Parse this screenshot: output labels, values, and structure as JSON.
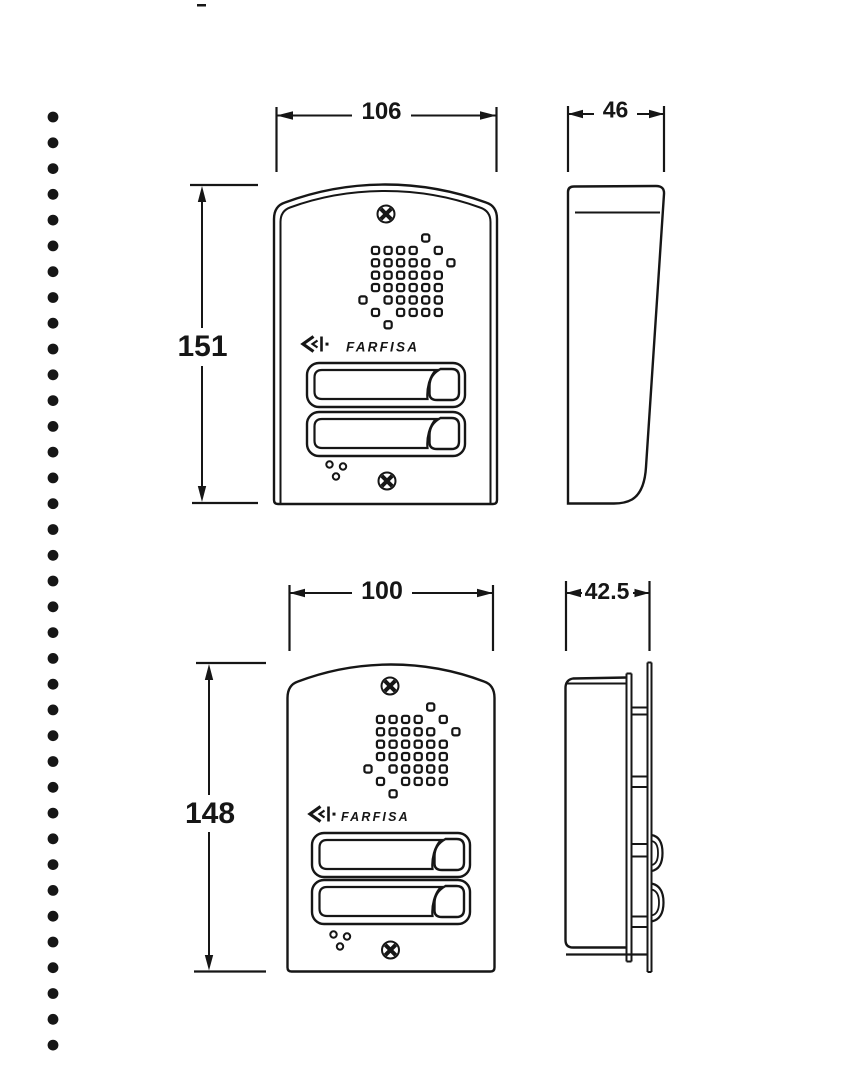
{
  "drawing": {
    "ink_color": "#161616",
    "paper_color": "#ffffff",
    "binding_dots_count": 37,
    "brand_logo_text": "FARFISA",
    "views": {
      "surface_front": {
        "width_mm": "106",
        "height_mm": "151"
      },
      "surface_side": {
        "depth_mm": "46"
      },
      "flush_front": {
        "width_mm": "100",
        "height_mm": "148"
      },
      "flush_side": {
        "depth_mm": "42.5"
      }
    },
    "speaker_grille_pattern": [
      ".....o..",
      ".oooo.o.",
      ".ooooo.o",
      ".oooooo.",
      ".oooooo.",
      "o.ooooo.",
      ".o.oooo.",
      "..o....."
    ]
  }
}
